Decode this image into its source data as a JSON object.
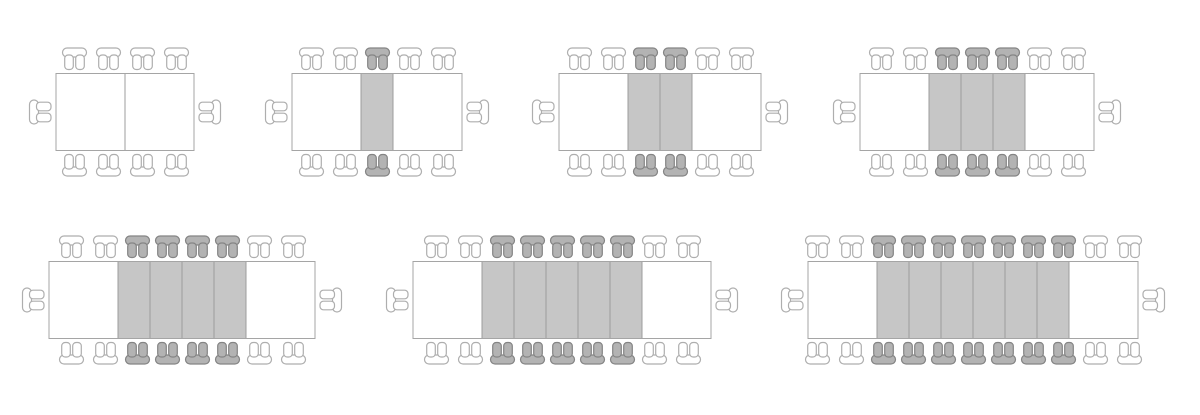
{
  "page": {
    "title": "Extendable table seating configurations",
    "background": "#ffffff",
    "rows": 2
  },
  "colors": {
    "table_border": "#a5a5a5",
    "section_divider": "#9c9c9c",
    "white_section_fill": "#ffffff",
    "leaf_fill": "#c6c6c6",
    "chair_outline": "#aeaeae",
    "chair_fill": "#ffffff",
    "shaded_chair_outline": "#848484",
    "shaded_chair_fill": "#b3b3b3"
  },
  "icons": {
    "chair": "chair-icon",
    "end_chair": "end-chair-icon"
  },
  "diagrams": [
    {
      "id": "configuration-1",
      "row": 1,
      "white_sections": 2,
      "leaves": 0,
      "chairs_per_side": 4,
      "shaded_chairs_per_side": 0,
      "end_chairs": 2,
      "total_seats": 10
    },
    {
      "id": "configuration-2",
      "row": 1,
      "white_sections": 2,
      "leaves": 1,
      "chairs_per_side": 5,
      "shaded_chairs_per_side": 1,
      "end_chairs": 2,
      "total_seats": 12
    },
    {
      "id": "configuration-3",
      "row": 1,
      "white_sections": 2,
      "leaves": 2,
      "chairs_per_side": 6,
      "shaded_chairs_per_side": 2,
      "end_chairs": 2,
      "total_seats": 14
    },
    {
      "id": "configuration-4",
      "row": 1,
      "white_sections": 2,
      "leaves": 3,
      "chairs_per_side": 7,
      "shaded_chairs_per_side": 3,
      "end_chairs": 2,
      "total_seats": 16
    },
    {
      "id": "configuration-5",
      "row": 2,
      "white_sections": 2,
      "leaves": 4,
      "chairs_per_side": 8,
      "shaded_chairs_per_side": 4,
      "end_chairs": 2,
      "total_seats": 18
    },
    {
      "id": "configuration-6",
      "row": 2,
      "white_sections": 2,
      "leaves": 5,
      "chairs_per_side": 9,
      "shaded_chairs_per_side": 5,
      "end_chairs": 2,
      "total_seats": 20
    },
    {
      "id": "configuration-7",
      "row": 2,
      "white_sections": 2,
      "leaves": 6,
      "chairs_per_side": 11,
      "shaded_chairs_per_side": 7,
      "end_chairs": 2,
      "total_seats": 24
    }
  ]
}
